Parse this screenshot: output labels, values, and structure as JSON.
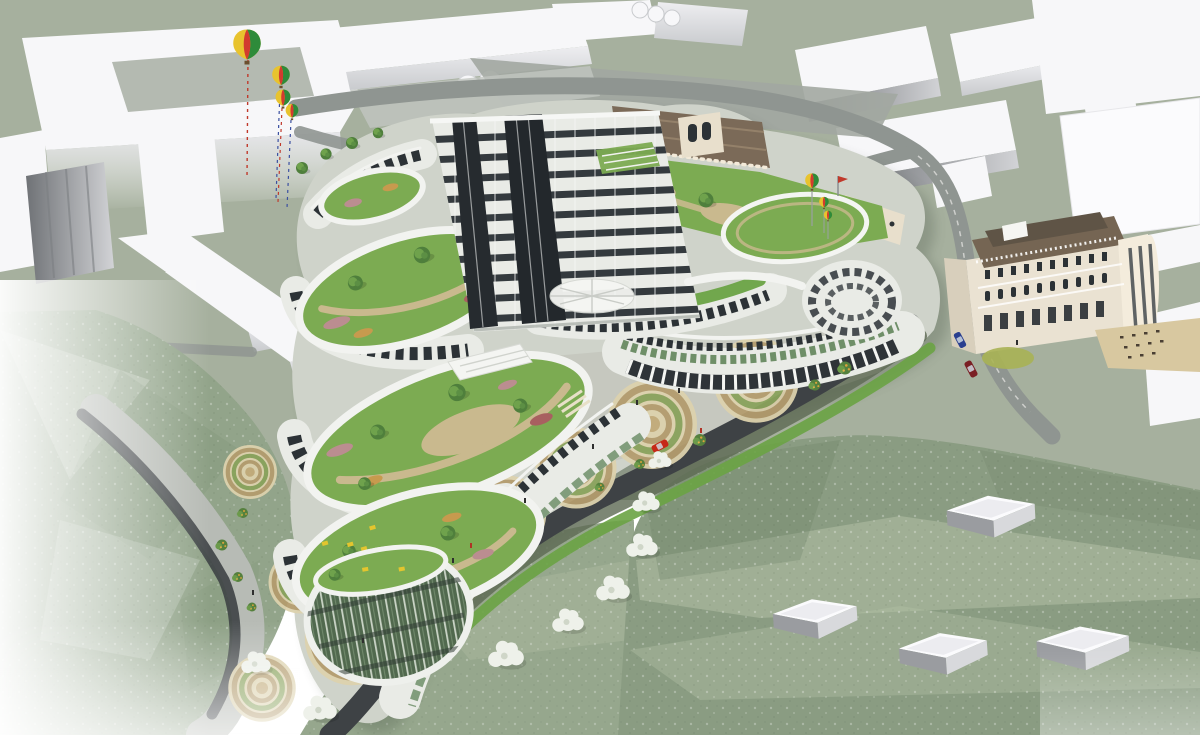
{
  "scene": {
    "aria_label": "Aerial architectural rendering of a curved terraced building complex with cascading green roof gardens, circular paved courtyards, a winding dark road, white context massing blocks, green hills, four striped hot air balloons and a classical corner building",
    "view": "aerial axonometric",
    "render_style": "3d architectural visualization"
  },
  "palette": {
    "background": "#ffffff",
    "context_ground": "#a6b09e",
    "courtyard_floor": "#b4bab1",
    "massing_white": "#f7f7f9",
    "massing_shade": "#d8d9dc",
    "facade_white": "#e9ebe6",
    "parapet_white": "#f2f3f0",
    "window_dark": "#2c3236",
    "glass_green": "#6f8f68",
    "lawn_green": "#7cab52",
    "path_tan": "#c9b98e",
    "paving_cream": "#ddd2ad",
    "paving_ring": "#b49c6e",
    "paving_grass_ring": "#8aa35c",
    "road_gray": "#8f9591",
    "road_asphalt": "#3e4245",
    "sidewalk": "#b7bbb5",
    "grass_strip": "#6aa344",
    "slope_dark": "#5d6953",
    "hill_green": "#92a48a",
    "hill_mid": "#96a78d",
    "hill_right": "#8a9c82",
    "esplanade": "#c6c8bf",
    "historic_roof": "#7b6a58",
    "historic_wall": "#e8dfcc",
    "classical_wall": "#eae2d2",
    "classical_roof": "#756553",
    "tree_green": "#4f7f3c",
    "blossom_white": "#eef1ea",
    "flower_pink": "#bb8d90",
    "flower_orange": "#c79a4e",
    "flower_russet": "#a86060",
    "cafe_yellow": "#e3c52e",
    "balloon_red": "#d23b2f",
    "balloon_green": "#2e8b3a",
    "balloon_yellow": "#e8c32e",
    "car_red": "#c62818",
    "car_blue": "#2a3f8f",
    "car_maroon": "#7a1f24"
  },
  "objects": {
    "hot_air_balloons_large": 4,
    "hot_air_balloons_small": 3,
    "cars": [
      "red",
      "blue",
      "dark-red"
    ],
    "circular_paving_motifs": 9,
    "green_roof_terraces": 6,
    "white_context_boxes": 4,
    "blossoming_trees": 8,
    "tower_floor_bands": 10
  }
}
